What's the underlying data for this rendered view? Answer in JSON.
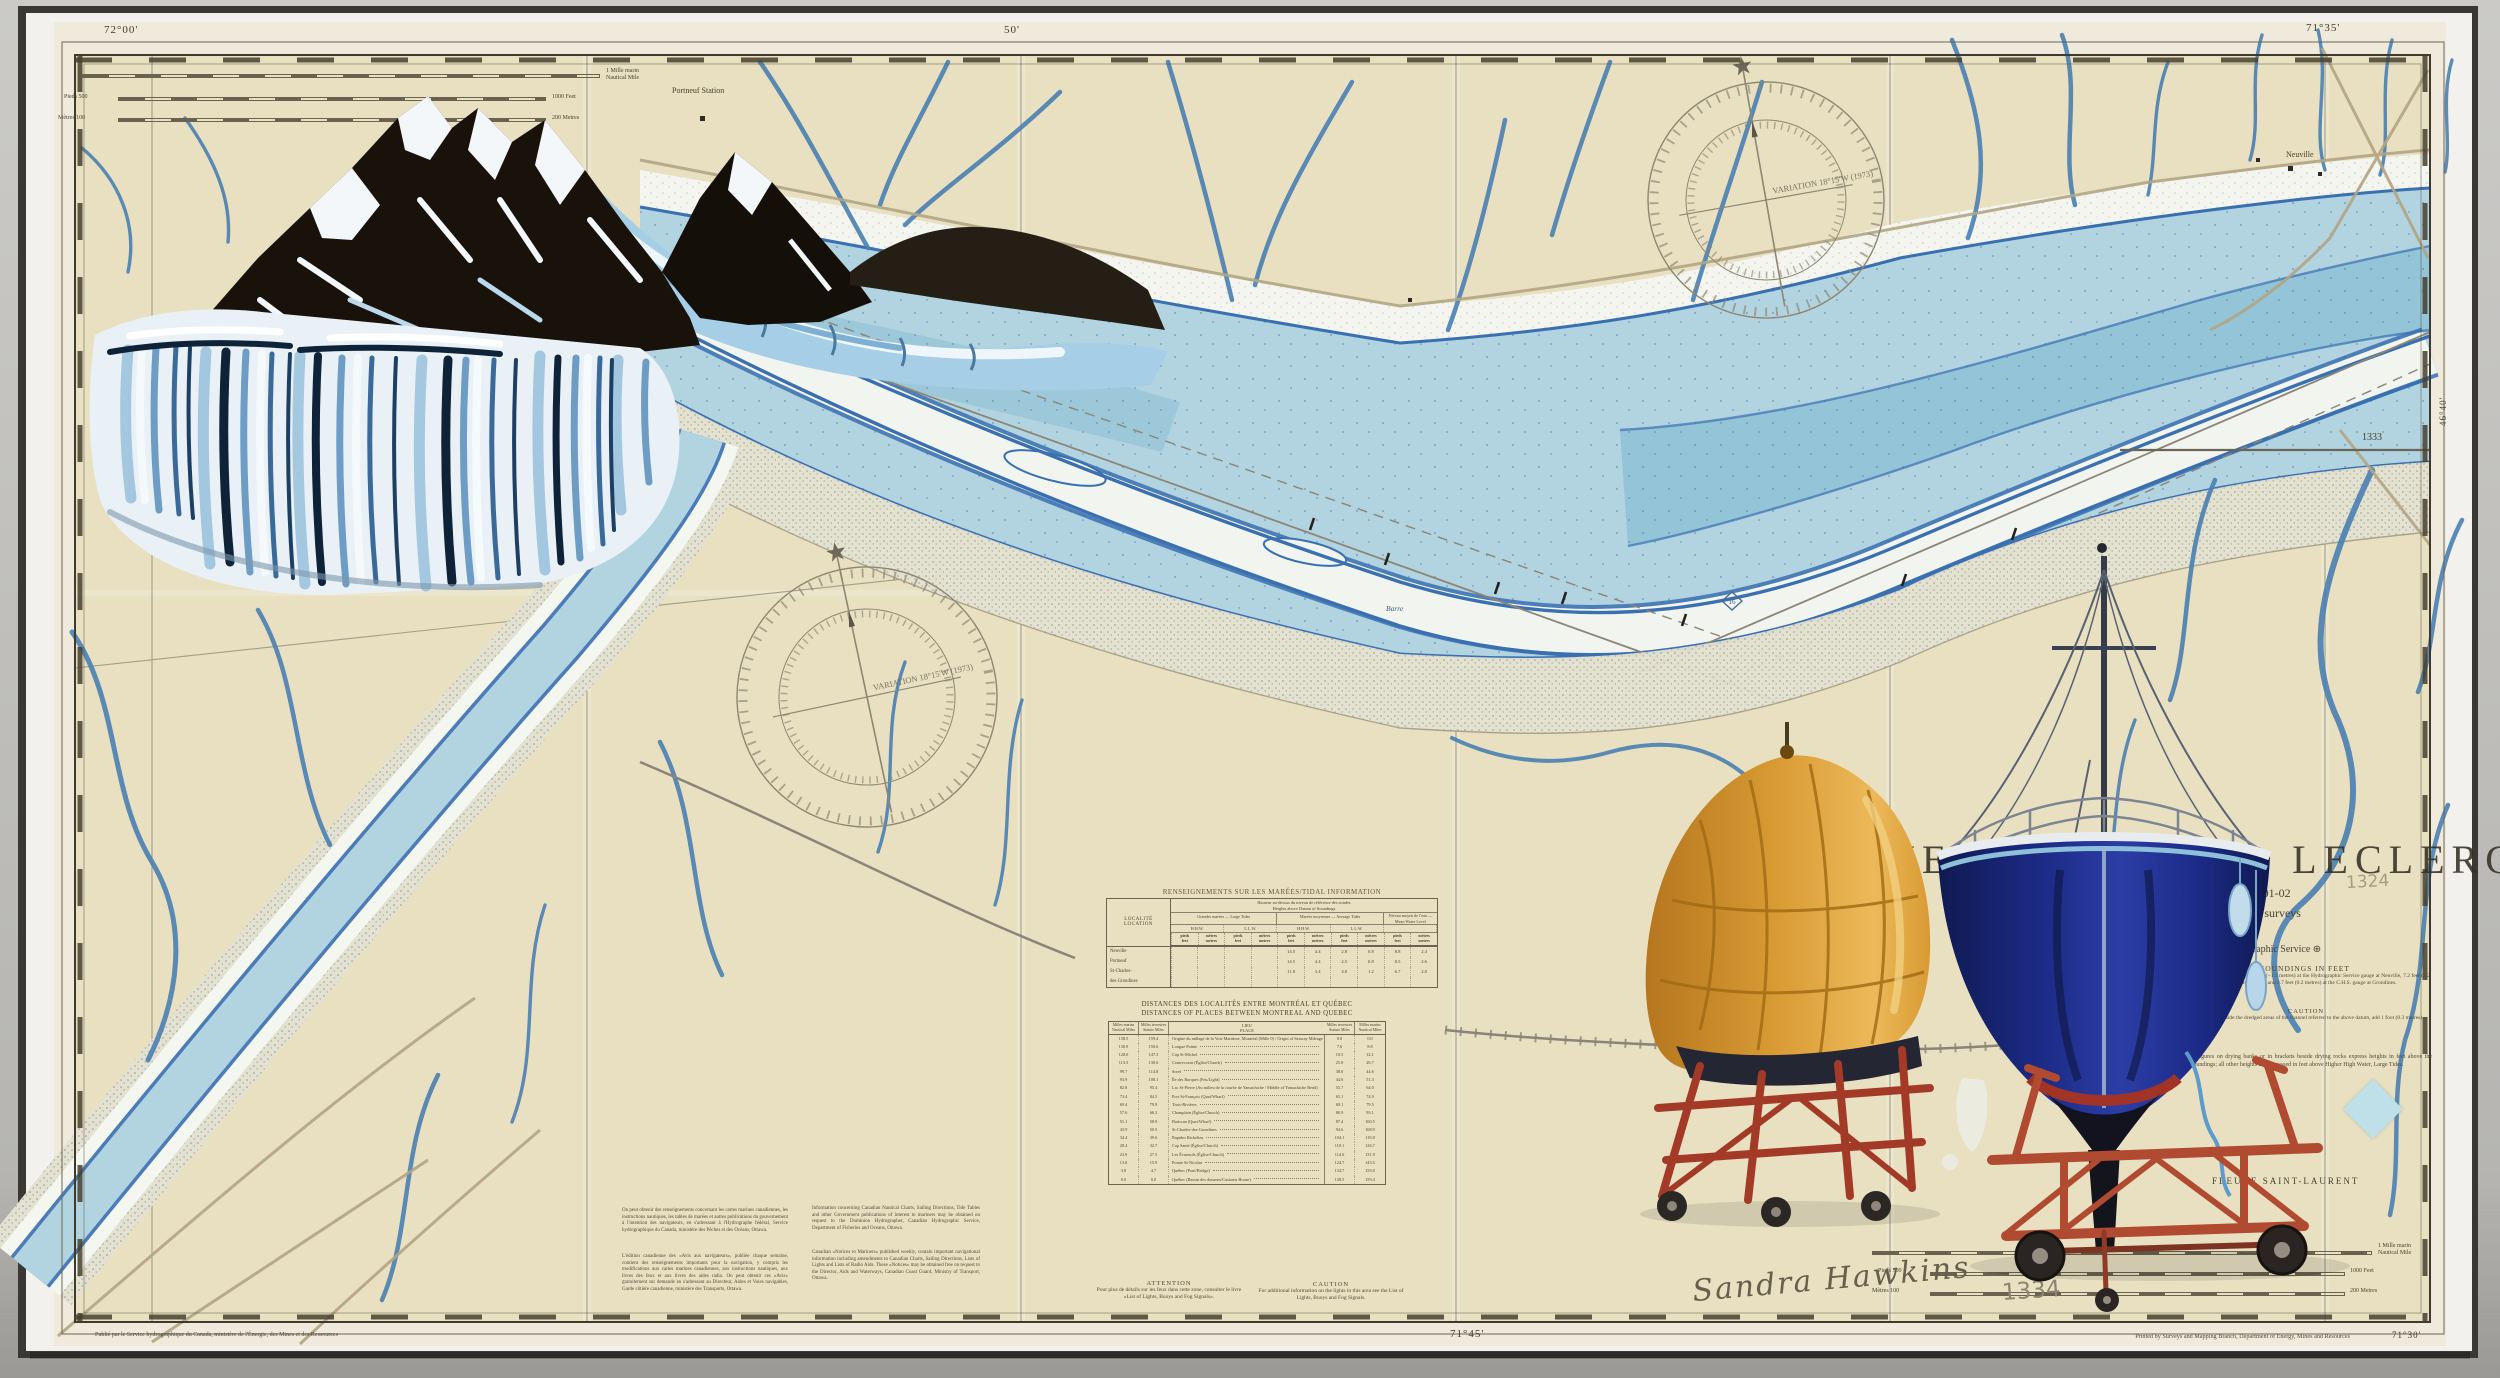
{
  "border": {
    "lon_left": "72°00'",
    "lon_mid": "50'",
    "lon_right": "71°35'",
    "lon_bottom": "71°45'",
    "lon_print": "71°30'",
    "lat_right": "46°40'",
    "adjoining_chart": "1333",
    "print_note": "Printed by Surveys and Mapping Branch, Department of Energy, Mines and Resources",
    "credit_fr": "Publié par le Service hydrographique du Canada, ministère de l'Énergie, des Mines et des Ressources"
  },
  "title_block": {
    "title": "NEUVILLE A/TO LECLERCVILLE",
    "subtitle1": "Surveys of 1901-02",
    "subtitle2": "updated from 1964 surveys",
    "agency": "Canadian Hydrographic Service ⊕",
    "soundings_heading": "SOUNDINGS IN FEET",
    "soundings_text": "Datum is based on elevation −4.9 feet (−1.5 metres) at the Hydrographic Service gauge at Neuville, 7.2 feet (2.2 metres) at the C.H.S. gauge at Portneuf and 0.7 feet (0.2 metres) at the C.H.S. gauge at Grondines.",
    "caution_heading": "CAUTION",
    "caution_text": "For soundings outside the dredged areas of the channel referred to the above datum, add 1 foot (0.3 metres).",
    "heights_note": "Underlined figures on drying banks or in brackets beside drying rocks express heights in feet above the datum of soundings; all other heights are expressed in feet above Higher High Water, Large Tides.",
    "projection": "Polyconic Projection",
    "river": "FLEUVE SAINT-LAURENT"
  },
  "map_labels": {
    "portneuf_station": "Portneuf Station",
    "neuville": "Neuville",
    "barre": "Barre",
    "depth_circle": "16",
    "variation": "VARIATION 18°15'W (1973)"
  },
  "scale_bars": {
    "nm1": "1 Mille marin",
    "nm2": "Nautical Mile",
    "feet_left": "Pieds 500",
    "feet_right": "1000 Feet",
    "metres_left": "Mètres 100",
    "metres_right": "200 Metres"
  },
  "tidal_table": {
    "title": "RENSEIGNEMENTS SUR LES MARÉES/TIDAL INFORMATION",
    "col_location_1": "LOCALITÉ",
    "col_location_2": "LOCATION",
    "span_1": "Hauteur au-dessus du niveau de référence des sondes",
    "span_2": "Heights above Datum of Soundings",
    "group1": "Grandes marées — Large Tides",
    "group2": "Marées moyennes — Average Tides",
    "group3": "Niveau moyen de l'eau — Mean Water Level",
    "sub_hhw": "H.H.W.",
    "sub_llw": "L.L.W.",
    "unit_p1": "pieds",
    "unit_p2": "feet",
    "unit_m1": "mètres",
    "unit_m2": "metres",
    "rows": [
      {
        "loc": "Neuville",
        "v": [
          "",
          "",
          "",
          "",
          "14.5",
          "4.4",
          "2.8",
          "0.8",
          "8.8",
          "2.4"
        ]
      },
      {
        "loc": "Portneuf",
        "v": [
          "",
          "",
          "",
          "",
          "14.5",
          "4.4",
          "2.5",
          "0.8",
          "8.5",
          "2.6"
        ]
      },
      {
        "loc": "St-Charles-",
        "v": [
          "",
          "",
          "",
          "",
          "11.8",
          "3.4",
          "4.0",
          "1.2",
          "6.7",
          "2.0"
        ]
      },
      {
        "loc": "des Grondines",
        "v": [
          "",
          "",
          "",
          "",
          "",
          "",
          "",
          "",
          "",
          ""
        ]
      }
    ]
  },
  "distance_table": {
    "title_fr": "DISTANCES DES LOCALITÉS ENTRE MONTRÉAL ET QUÉBEC",
    "title_en": "DISTANCES OF PLACES BETWEEN MONTREAL AND QUEBEC",
    "h_nm1": "Milles",
    "h_nm2": "marins",
    "h_nm3": "Nautical",
    "h_nm4": "Miles",
    "h_sm1": "Milles",
    "h_sm2": "terrestres",
    "h_sm3": "Statute",
    "h_sm4": "Miles",
    "h_place1": "LIEU",
    "h_place2": "PLACE",
    "rows": [
      [
        "138.5",
        "159.4",
        "Origine du millage de la Voie Maritime, Montréal (Mille 0) / Origin of Seaway Mileage (Mile 0)",
        "0.0",
        "0.0"
      ],
      [
        "130.9",
        "150.6",
        "Longue Pointe",
        "7.6",
        "8.8"
      ],
      [
        "128.0",
        "147.3",
        "Cap St-Michel",
        "10.5",
        "12.1"
      ],
      [
        "113.5",
        "130.6",
        "Contrecoeur (Église/Church)",
        "25.0",
        "28.7"
      ],
      [
        "99.7",
        "114.8",
        "Sorel",
        "38.8",
        "44.6"
      ],
      [
        "93.9",
        "108.1",
        "Île des Barques (Feu/Light)",
        "44.6",
        "51.3"
      ],
      [
        "82.8",
        "95.4",
        "Lac St-Pierre (Au milieu de la courbe de Yamachiche / Middle of Yamachiche Bend)",
        "55.7",
        "64.0"
      ],
      [
        "73.4",
        "84.5",
        "Port St-François (Quai/Wharf)",
        "65.1",
        "74.9"
      ],
      [
        "69.4",
        "79.9",
        "Trois-Rivières",
        "69.1",
        "79.5"
      ],
      [
        "57.6",
        "66.3",
        "Champlain (Église/Church)",
        "80.9",
        "93.1"
      ],
      [
        "51.1",
        "58.9",
        "Batiscan (Quai/Wharf)",
        "87.4",
        "100.5"
      ],
      [
        "43.9",
        "50.5",
        "St-Charles-des-Grondines",
        "94.6",
        "108.9"
      ],
      [
        "34.4",
        "39.6",
        "Rapides Richelieu",
        "104.1",
        "119.8"
      ],
      [
        "28.4",
        "32.7",
        "Cap Santé (Église/Church)",
        "110.1",
        "126.7"
      ],
      [
        "23.9",
        "27.5",
        "Les Écureuils (Église/Church)",
        "114.6",
        "131.9"
      ],
      [
        "13.8",
        "15.9",
        "Pointe St-Nicolas",
        "124.7",
        "143.5"
      ],
      [
        "3.8",
        "4.7",
        "Québec (Pont/Bridge)",
        "134.7",
        "155.0"
      ],
      [
        "0.0",
        "0.0",
        "Québec (Bassin des douanes/Customs House)",
        "138.5",
        "159.4"
      ]
    ]
  },
  "attention": {
    "heading": "ATTENTION",
    "text": "Pour plus de détails sur les feux dans cette zone, consulter le livre «List of Lights, Buoys and Fog Signals»."
  },
  "caution": {
    "heading": "CAUTION",
    "text": "For additional information on the lights in this area see the List of Lights, Buoys and Fog Signals."
  },
  "paragraphs": {
    "fr1": "On peut obtenir des renseignements concernant les cartes marines canadiennes, les instructions nautiques, les tables de marées et autres publications du gouvernement à l'intention des navigateurs, en s'adressant à l'Hydrographe fédéral, Service hydrographique du Canada, ministère des Pêches et des Océans, Ottawa.",
    "fr2": "L'édition canadienne des «Avis aux navigateurs», publiée chaque semaine, contient des renseignements importants pour la navigation, y compris les modifications aux cartes marines canadiennes, aux instructions nautiques, aux livres des feux et aux livres des aides radio. On peut obtenir ces «Avis» gratuitement sur demande en s'adressant au Directeur, Aides et Voies navigables, Garde côtière canadienne, ministère des Transports, Ottawa.",
    "en1": "Information concerning Canadian Nautical Charts, Sailing Directions, Tide Tables and other Government publications of interest to mariners may be obtained on request to the Dominion Hydrographer, Canadian Hydrographic Service, Department of Fisheries and Oceans, Ottawa.",
    "en2": "Canadian «Notices to Mariners» published weekly, contain important navigational information including amendments to Canadian Charts, Sailing Directions, Lists of Lights and Lists of Radio Aids. These «Notices» may be obtained free on request to the Director, Aids and Waterways, Canadian Coast Guard, Ministry of Transport, Ottawa."
  },
  "annotations": {
    "signature": "Sandra Hawkins",
    "pencil_number": "1334",
    "pencil_number_top": "1324"
  }
}
